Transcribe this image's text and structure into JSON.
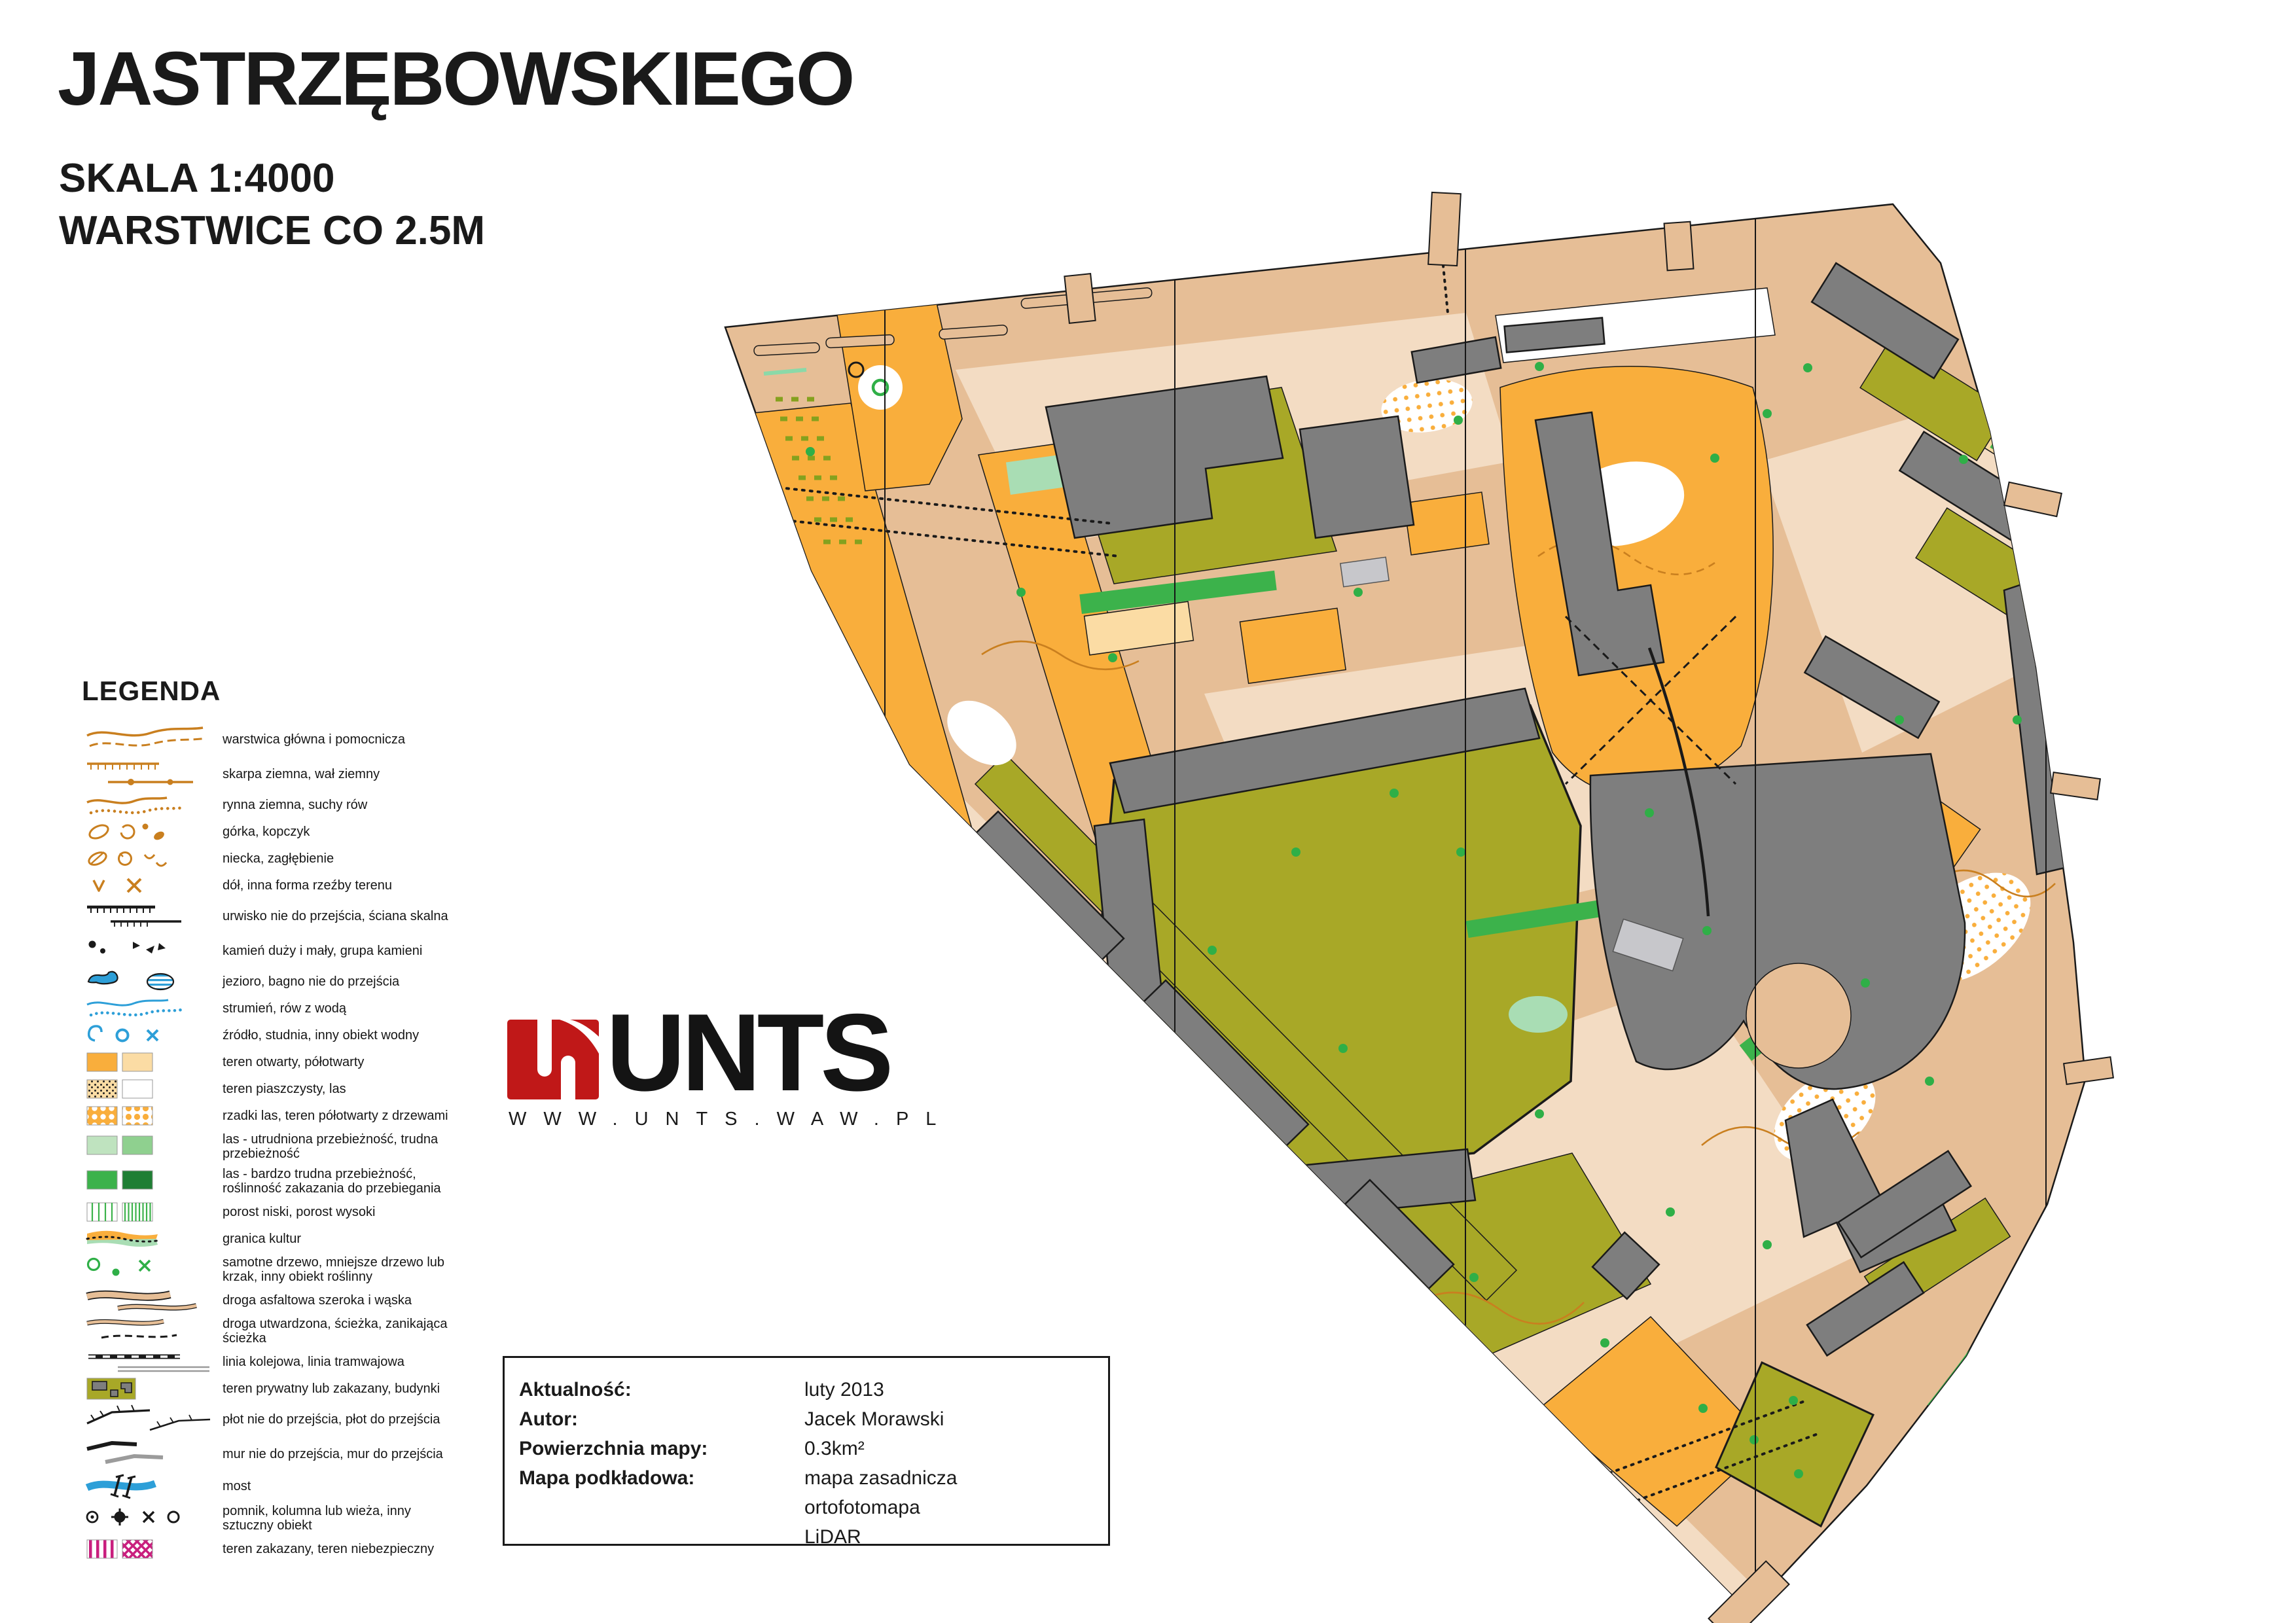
{
  "header": {
    "title": "JASTRZĘBOWSKIEGO",
    "scale": "SKALA 1:4000",
    "contours": "WARSTWICE CO 2.5M"
  },
  "legend": {
    "title": "LEGENDA",
    "items": [
      {
        "icon": "contour-lines",
        "label": "warstwica główna i pomocnicza"
      },
      {
        "icon": "earth-bank",
        "label": "skarpa ziemna, wał ziemny"
      },
      {
        "icon": "erosion-gully",
        "label": "rynna ziemna, suchy rów"
      },
      {
        "icon": "knoll",
        "label": "górka, kopczyk"
      },
      {
        "icon": "depression",
        "label": "niecka, zagłębienie"
      },
      {
        "icon": "pit",
        "label": "dół, inna forma rzeźby terenu"
      },
      {
        "icon": "cliff",
        "label": "urwisko nie do przejścia, ściana skalna"
      },
      {
        "icon": "boulders",
        "label": "kamień duży i mały, grupa kamieni"
      },
      {
        "icon": "lake-marsh",
        "label": "jezioro, bagno nie do przejścia"
      },
      {
        "icon": "stream",
        "label": "strumień, rów z wodą"
      },
      {
        "icon": "water-object",
        "label": "źródło, studnia, inny obiekt wodny"
      },
      {
        "icon": "open-land",
        "label": "teren otwarty, półotwarty"
      },
      {
        "icon": "sandy-ground",
        "label": "teren piaszczysty, las"
      },
      {
        "icon": "scattered-trees",
        "label": "rzadki las, teren półotwarty z drzewami"
      },
      {
        "icon": "forest-slow",
        "label": "las - utrudniona przebieżność, trudna przebieżność"
      },
      {
        "icon": "forest-fight",
        "label": "las - bardzo trudna przebieżność, roślinność zakazania do przebiegania"
      },
      {
        "icon": "undergrowth",
        "label": "porost niski, porost wysoki"
      },
      {
        "icon": "cultivation-boundary",
        "label": "granica kultur"
      },
      {
        "icon": "tree-bush",
        "label": "samotne drzewo, mniejsze drzewo lub krzak, inny obiekt roślinny"
      },
      {
        "icon": "paved-road",
        "label": "droga asfaltowa szeroka i wąska"
      },
      {
        "icon": "footpath",
        "label": "droga utwardzona, ścieżka, zanikająca ścieżka"
      },
      {
        "icon": "railway-tram",
        "label": "linia kolejowa, linia tramwajowa"
      },
      {
        "icon": "private-area-buildings",
        "label": "teren prywatny lub zakazany, budynki"
      },
      {
        "icon": "fence",
        "label": "płot nie do przejścia, płot do przejścia"
      },
      {
        "icon": "wall",
        "label": "mur nie do przejścia, mur do przejścia"
      },
      {
        "icon": "bridge",
        "label": "most"
      },
      {
        "icon": "monument-tower",
        "label": "pomnik, kolumna lub wieża, inny sztuczny obiekt"
      },
      {
        "icon": "forbidden-area",
        "label": "teren zakazany, teren niebezpieczny"
      }
    ]
  },
  "logo": {
    "brand": "UNTS",
    "website": "WWW.UNTS.WAW.PL"
  },
  "info_box": {
    "rows": [
      {
        "label": "Aktualność:",
        "value": "luty 2013"
      },
      {
        "label": "Autor:",
        "value": "Jacek Morawski"
      },
      {
        "label": "Powierzchnia mapy:",
        "value": "0.3km²"
      },
      {
        "label": "Mapa podkładowa:",
        "values": [
          "mapa zasadnicza",
          "ortofotomapa",
          "LiDAR"
        ]
      }
    ]
  },
  "palette": {
    "road": "#E6BE96",
    "paved": "#F3DCC3",
    "orange": "#F9AE3C",
    "pale_orange": "#FBDCA4",
    "olive": "#A8A827",
    "olive_dash": "#85A11E",
    "green": "#2FAF47",
    "light_green": "#A9DDB4",
    "veg_light": "#BFE3BF",
    "veg_mid": "#8FD08F",
    "veg_dark": "#3CB24B",
    "veg_darkest": "#1E7E34",
    "building": "#7E7E7E",
    "canopy": "#C7C7CB",
    "contour": "#C97F1F",
    "water": "#2D9FD8",
    "magenta": "#C91F7E",
    "brand_red": "#C01818",
    "ink": "#1A1A1A"
  }
}
